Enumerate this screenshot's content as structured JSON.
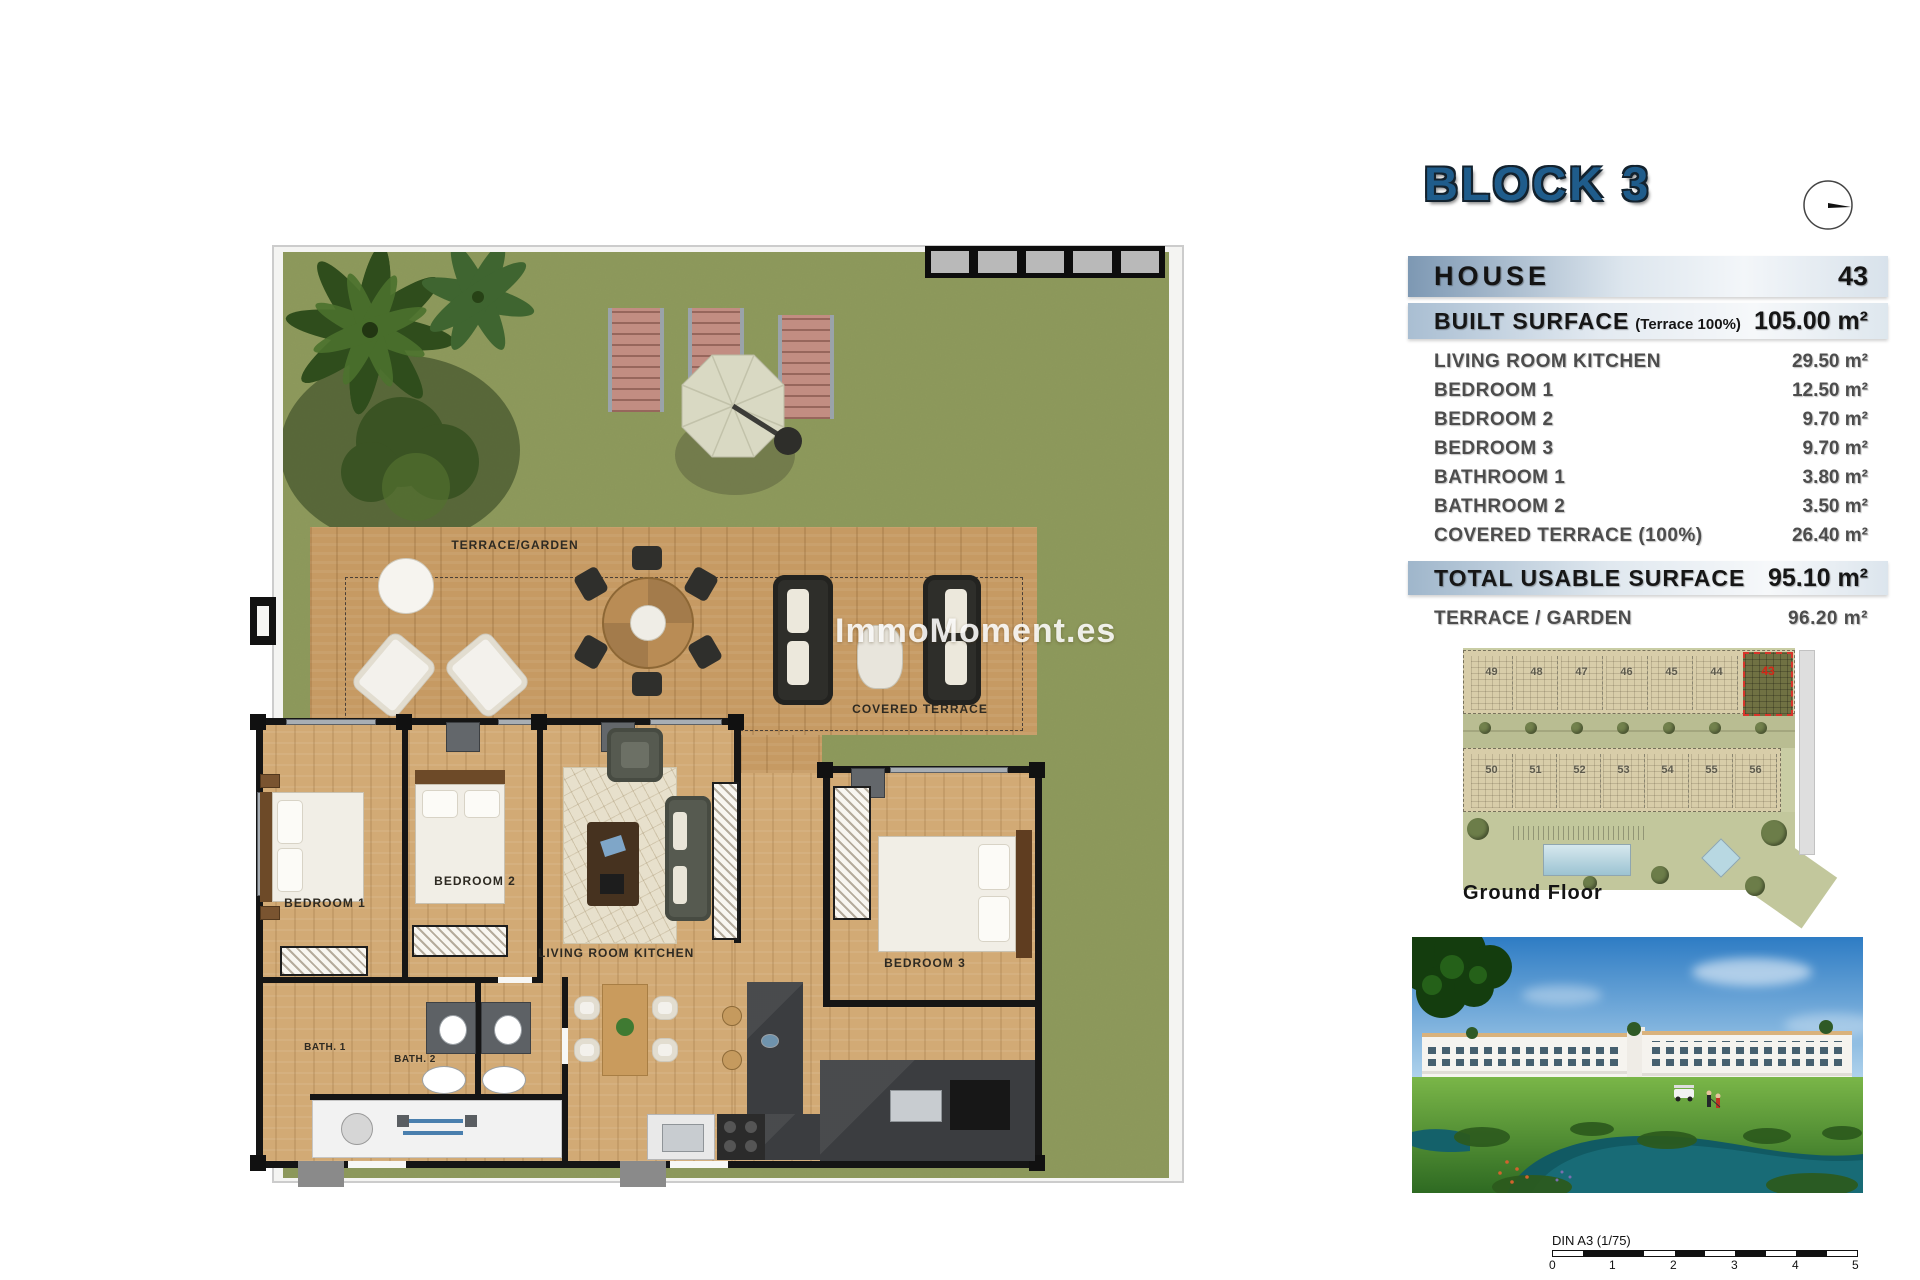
{
  "header": {
    "block_title": "BLOCK 3",
    "house_label": "HOUSE",
    "house_number": "43"
  },
  "summary": {
    "built_surface_label": "BUILT SURFACE",
    "built_surface_note": "(Terrace 100%)",
    "built_surface_value": "105.00 m²",
    "rooms": [
      {
        "label": "LIVING ROOM KITCHEN",
        "value": "29.50 m²"
      },
      {
        "label": "BEDROOM 1",
        "value": "12.50 m²"
      },
      {
        "label": "BEDROOM 2",
        "value": "9.70 m²"
      },
      {
        "label": "BEDROOM 3",
        "value": "9.70 m²"
      },
      {
        "label": "BATHROOM 1",
        "value": "3.80 m²"
      },
      {
        "label": "BATHROOM 2",
        "value": "3.50 m²"
      },
      {
        "label": "COVERED TERRACE (100%)",
        "value": "26.40 m²"
      }
    ],
    "total_label": "TOTAL USABLE SURFACE",
    "total_value": "95.10 m²",
    "terrace_label": "TERRACE / GARDEN",
    "terrace_value": "96.20 m²"
  },
  "floorplan": {
    "labels": {
      "terrace_garden": "TERRACE/GARDEN",
      "covered_terrace": "COVERED TERRACE",
      "bedroom1": "BEDROOM 1",
      "bedroom2": "BEDROOM 2",
      "bedroom3": "BEDROOM 3",
      "living": "LIVING ROOM KITCHEN",
      "bath1": "BATH. 1",
      "bath2": "BATH. 2"
    },
    "watermark": "ImmoMoment.es"
  },
  "siteplan": {
    "caption": "Ground Floor",
    "top_row": [
      "49",
      "48",
      "47",
      "46",
      "45",
      "44"
    ],
    "highlight_unit": "43",
    "bottom_row": [
      "50",
      "51",
      "52",
      "53",
      "54",
      "55",
      "56"
    ]
  },
  "scalebar": {
    "label": "DIN A3 (1/75)",
    "ticks": [
      "0",
      "1",
      "2",
      "3",
      "4",
      "5"
    ]
  },
  "colors": {
    "accent_blue": "#1f5c8b",
    "bar_gradient_left": "#7d98b3",
    "grass": "#8e9a5c",
    "terrace_wood": "#c69a63",
    "interior_wood": "#d2aa75",
    "wall": "#151515",
    "highlight_red": "#d8342a"
  }
}
